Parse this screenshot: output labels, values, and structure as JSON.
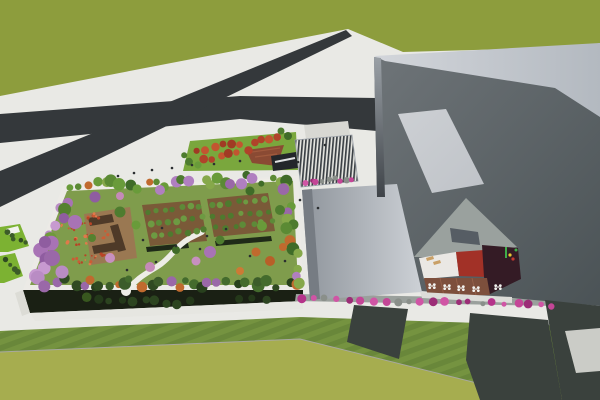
{
  "scene_type": "aerial-architectural-rendering",
  "colors": {
    "concrete": "#e9e9e5",
    "grass_top": "#8d9d3d",
    "grass_bottom": "#a6ad4f",
    "lawn_stripe_dark": "#69873a",
    "lawn_stripe_light": "#759340",
    "road": "#34383b",
    "crosswalk": "#d8d8d3",
    "park_green": "#7cb232",
    "pavilion_white": "#f2f2ee",
    "garden_rim": "#eceae6",
    "garden_lawn": "#7f9c4c",
    "facade_dark": "#1a2014",
    "wall_white": "#e6e6e1",
    "west_wall": "#dcdcd6",
    "orchard_soil": "#7a5a38",
    "deck_wood": "#9a7852",
    "deck_dark": "#4e3a28",
    "hedge_dark": "#1f2a18",
    "path_white": "#eeede7",
    "north_lawn": "#7aa73d",
    "amphitheater": "#8a4a33",
    "amphitheater_step": "#a05a3d",
    "kiosk_dark": "#23262a",
    "kiosk_front": "#dfe0e2",
    "canopy_light": "#e6e6e1",
    "canopy_dark": "#3a3f44",
    "planting_strip": "#9aa09c",
    "roof_strip_left": "#d3d6db",
    "roof_strip_right": "#b3b9c0",
    "roof_dark_top": "#6e7478",
    "roof_dark_bottom": "#4b5356",
    "wing_left": "#8f959c",
    "wing_right": "#cdd1d6",
    "wing_edge": "#767c83",
    "tower_edge_top": "#9aa0a6",
    "tower_edge_bottom": "#3e4348",
    "skylight_panel_a": "#cdd0d4",
    "skylight_panel_b": "#bfc3c8",
    "court_wall": "#9aa19e",
    "court_panel": "#565d64",
    "court_floor_white": "#eae8e4",
    "court_floor_red": "#a23127",
    "court_floor_maroon": "#341b25",
    "court_terrace": "#7d4f3c",
    "court_terrace_line": "#96614a",
    "lounger": "#c9a066",
    "eave_white": "#dcdcd8",
    "play_green": "#3fae4a",
    "play_yellow": "#e8c832",
    "play_red": "#c03a30",
    "shadow": "#3a413d",
    "light_path": "#cbccc7",
    "lawn_edge_line": "#a8a8a0",
    "person": "#2b2e30",
    "table_white": "#f2f2ef"
  },
  "palettes": {
    "mixed": [
      "#4e7c2f",
      "#699b3a",
      "#3f6b28",
      "#86a84a",
      "#9a68a8",
      "#b07fc0",
      "#c06a2e",
      "#5b8a34"
    ],
    "purpleMix": [
      "#a873b5",
      "#b98cc4",
      "#8f5da0",
      "#6f9a3c",
      "#c79ad0",
      "#55812f"
    ],
    "darkMix": [
      "#2f4a22",
      "#3c5c2a",
      "#28401d",
      "#c06a2e",
      "#9a68a8",
      "#446b2d"
    ],
    "olive": [
      "#5d8a38",
      "#4e7a2e",
      "#6d9a42"
    ],
    "redbed": [
      "#cc5c35",
      "#b84427",
      "#e07a4a"
    ],
    "redtree": [
      "#b0432a",
      "#c25530",
      "#a03b24"
    ],
    "greens": [
      "#4e7c2f",
      "#699b3a"
    ],
    "pinkBush": [
      "#b5338a",
      "#c44697",
      "#9c2d77",
      "#d055a5",
      "#8a8f8a"
    ],
    "darkShrub": [
      "#3c5c28",
      "#2f4a22"
    ],
    "overhang": [
      "#2c4420",
      "#38571f",
      "#24381a"
    ]
  },
  "clusters": [
    {
      "name": "garden-top-belt",
      "x1": 70,
      "y1": 187,
      "x2": 290,
      "y2": 178,
      "n": 26,
      "spread": 5,
      "rmin": 3,
      "rmax": 6.5,
      "palette": "mixed",
      "seed": 7
    },
    {
      "name": "garden-left-belt",
      "x1": 66,
      "y1": 198,
      "x2": 36,
      "y2": 278,
      "n": 13,
      "spread": 6,
      "rmin": 4,
      "rmax": 8,
      "palette": "purpleMix",
      "seed": 11
    },
    {
      "name": "garden-bottom-belt",
      "x1": 48,
      "y1": 282,
      "x2": 296,
      "y2": 285,
      "n": 30,
      "spread": 5,
      "rmin": 3,
      "rmax": 6.5,
      "palette": "darkMix",
      "seed": 23
    },
    {
      "name": "garden-right-belt",
      "x1": 286,
      "y1": 186,
      "x2": 296,
      "y2": 280,
      "n": 13,
      "spread": 5,
      "rmin": 3.5,
      "rmax": 6.5,
      "palette": "mixed",
      "seed": 31
    },
    {
      "name": "orchard-row-a1",
      "x1": 147,
      "y1": 211,
      "x2": 199,
      "y2": 206,
      "n": 7,
      "spread": 1.5,
      "rmin": 2.5,
      "rmax": 3.5,
      "palette": "olive",
      "seed": 41
    },
    {
      "name": "orchard-row-a2",
      "x1": 150,
      "y1": 223,
      "x2": 202,
      "y2": 218,
      "n": 7,
      "spread": 1.5,
      "rmin": 2.5,
      "rmax": 3.5,
      "palette": "olive",
      "seed": 42
    },
    {
      "name": "orchard-row-a3",
      "x1": 153,
      "y1": 235,
      "x2": 205,
      "y2": 230,
      "n": 7,
      "spread": 1.5,
      "rmin": 2.5,
      "rmax": 3.5,
      "palette": "olive",
      "seed": 43
    },
    {
      "name": "orchard-row-b1",
      "x1": 211,
      "y1": 205,
      "x2": 265,
      "y2": 199,
      "n": 7,
      "spread": 1.5,
      "rmin": 2.5,
      "rmax": 3.5,
      "palette": "olive",
      "seed": 44
    },
    {
      "name": "orchard-row-b2",
      "x1": 214,
      "y1": 217,
      "x2": 268,
      "y2": 211,
      "n": 7,
      "spread": 1.5,
      "rmin": 2.5,
      "rmax": 3.5,
      "palette": "olive",
      "seed": 45
    },
    {
      "name": "orchard-row-b3",
      "x1": 217,
      "y1": 228,
      "x2": 271,
      "y2": 222,
      "n": 7,
      "spread": 1.5,
      "rmin": 2.5,
      "rmax": 3.5,
      "palette": "olive",
      "seed": 46
    },
    {
      "name": "flower-bed-1",
      "x1": 64,
      "y1": 228,
      "x2": 98,
      "y2": 215,
      "n": 18,
      "spread": 5,
      "rmin": 0.8,
      "rmax": 1.8,
      "palette": "redbed",
      "seed": 51
    },
    {
      "name": "flower-bed-2",
      "x1": 70,
      "y1": 245,
      "x2": 104,
      "y2": 234,
      "n": 18,
      "spread": 5,
      "rmin": 0.8,
      "rmax": 1.8,
      "palette": "redbed",
      "seed": 52
    },
    {
      "name": "flower-bed-3",
      "x1": 75,
      "y1": 264,
      "x2": 110,
      "y2": 252,
      "n": 18,
      "spread": 5,
      "rmin": 0.8,
      "rmax": 1.8,
      "palette": "redbed",
      "seed": 53
    },
    {
      "name": "north-red-trees-1",
      "x1": 196,
      "y1": 150,
      "x2": 240,
      "y2": 143,
      "n": 6,
      "spread": 2,
      "rmin": 3,
      "rmax": 4.5,
      "palette": "redtree",
      "seed": 61
    },
    {
      "name": "north-red-trees-2",
      "x1": 203,
      "y1": 159,
      "x2": 247,
      "y2": 152,
      "n": 6,
      "spread": 2,
      "rmin": 3,
      "rmax": 4.5,
      "palette": "redtree",
      "seed": 62
    },
    {
      "name": "north-red-trees-3",
      "x1": 254,
      "y1": 143,
      "x2": 276,
      "y2": 138,
      "n": 4,
      "spread": 2,
      "rmin": 3,
      "rmax": 4.2,
      "palette": "redtree",
      "seed": 63
    },
    {
      "name": "north-green-trees",
      "x1": 186,
      "y1": 157,
      "x2": 196,
      "y2": 166,
      "n": 3,
      "spread": 2,
      "rmin": 3,
      "rmax": 4,
      "palette": "greens",
      "seed": 71
    },
    {
      "name": "sidewalk-bushes",
      "x1": 302,
      "y1": 299,
      "x2": 553,
      "y2": 305,
      "n": 22,
      "spread": 2,
      "rmin": 2.5,
      "rmax": 4.5,
      "palette": "pinkBush",
      "seed": 81
    },
    {
      "name": "pocket-park-shrubs-1",
      "x1": 6,
      "y1": 231,
      "x2": 24,
      "y2": 244,
      "n": 5,
      "spread": 2,
      "rmin": 2,
      "rmax": 3,
      "palette": "darkShrub",
      "seed": 91
    },
    {
      "name": "pocket-park-shrubs-2",
      "x1": 4,
      "y1": 259,
      "x2": 18,
      "y2": 272,
      "n": 4,
      "spread": 2,
      "rmin": 2,
      "rmax": 3,
      "palette": "darkShrub",
      "seed": 92
    },
    {
      "name": "facade-overhang-trees",
      "x1": 88,
      "y1": 299,
      "x2": 190,
      "y2": 303,
      "n": 10,
      "spread": 2.5,
      "rmin": 3,
      "rmax": 5,
      "palette": "overhang",
      "seed": 101
    },
    {
      "name": "facade-overhang-trees-2",
      "x1": 240,
      "y1": 297,
      "x2": 265,
      "y2": 299,
      "n": 3,
      "spread": 2,
      "rmin": 3,
      "rmax": 4.5,
      "palette": "overhang",
      "seed": 102
    },
    {
      "name": "canopy-flowers",
      "x1": 305,
      "y1": 183,
      "x2": 352,
      "y2": 178,
      "n": 9,
      "spread": 2,
      "rmin": 2,
      "rmax": 3.2,
      "palette": "pinkBush",
      "seed": 111
    }
  ],
  "trees": [
    [
      75,
      222,
      7,
      "#a873b5"
    ],
    [
      52,
      258,
      8,
      "#9a68a8"
    ],
    [
      62,
      272,
      6.5,
      "#b98cc4"
    ],
    [
      95,
      197,
      5.5,
      "#8f5da0"
    ],
    [
      210,
      252,
      6,
      "#a873b5"
    ],
    [
      160,
      190,
      5,
      "#b07fc0"
    ],
    [
      230,
      184,
      5,
      "#9a68a8"
    ],
    [
      45,
      242,
      6,
      "#8f5da0"
    ],
    [
      110,
      258,
      5,
      "#c790c0"
    ],
    [
      150,
      267,
      5,
      "#c58ab8"
    ],
    [
      196,
      261,
      4.5,
      "#c790c0"
    ],
    [
      120,
      196,
      4,
      "#c58ab8"
    ],
    [
      256,
      252,
      4.5,
      "#c06a2e"
    ],
    [
      270,
      261,
      5,
      "#b85f28"
    ],
    [
      283,
      247,
      4,
      "#c06a2e"
    ],
    [
      240,
      271,
      4,
      "#cc7a35"
    ],
    [
      90,
      280,
      4.5,
      "#c06a2e"
    ],
    [
      120,
      212,
      5.5,
      "#4e7c2f"
    ],
    [
      136,
      225,
      4.5,
      "#699b3a"
    ],
    [
      176,
      250,
      4,
      "#3f6b28"
    ],
    [
      92,
      238,
      4,
      "#55812f"
    ],
    [
      220,
      240,
      4.5,
      "#4e7c2f"
    ],
    [
      262,
      226,
      5,
      "#699b3a"
    ],
    [
      280,
      210,
      5,
      "#4e7c2f"
    ],
    [
      250,
      191,
      4.5,
      "#3f6b28"
    ],
    [
      288,
      136,
      4,
      "#3f6b28"
    ],
    [
      281,
      131,
      3.5,
      "#4e7c2f"
    ]
  ],
  "people": [
    [
      118,
      176
    ],
    [
      134,
      173
    ],
    [
      152,
      170
    ],
    [
      172,
      168
    ],
    [
      192,
      165
    ],
    [
      214,
      164
    ],
    [
      240,
      161
    ],
    [
      298,
      162
    ],
    [
      300,
      200
    ],
    [
      325,
      145
    ],
    [
      318,
      208
    ],
    [
      156,
      262
    ],
    [
      176,
      246
    ],
    [
      200,
      249
    ],
    [
      226,
      229
    ],
    [
      127,
      270
    ],
    [
      207,
      236
    ],
    [
      250,
      256
    ],
    [
      285,
      261
    ],
    [
      162,
      228
    ],
    [
      143,
      240
    ]
  ],
  "table_sets": [
    [
      432,
      286
    ],
    [
      447,
      287
    ],
    [
      461,
      288
    ],
    [
      476,
      289
    ],
    [
      498,
      287
    ]
  ]
}
